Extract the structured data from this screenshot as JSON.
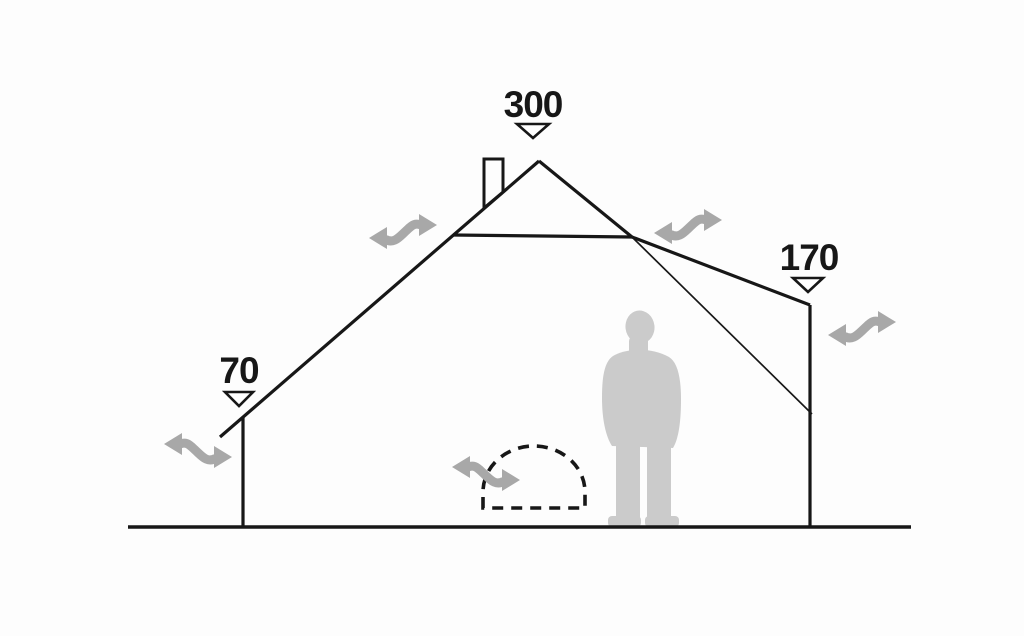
{
  "diagram": {
    "name": "tent-cross-section-dimensions",
    "description": "Side cut-away view of a tent showing interior heights, ventilation airflow, stove opening and a human figure for scale",
    "measurements": {
      "peak_height": "300",
      "left_wall_height": "70",
      "right_wall_height": "170"
    },
    "icons": {
      "airflow_arrow": "double-headed-wavy-arrow",
      "measure_marker": "triangle-down-outline",
      "chimney": "stove-pipe-rectangle",
      "scale_figure": "standing-person-silhouette",
      "stove_opening": "dashed-dome-outline"
    },
    "colors": {
      "background": "#fdfdfd",
      "outline": "#171717",
      "airflow_arrow": "#a8a8a8",
      "figure": "#cbcbcb",
      "marker_fill": "#ffffff"
    },
    "airflow_arrow_count": "5"
  }
}
